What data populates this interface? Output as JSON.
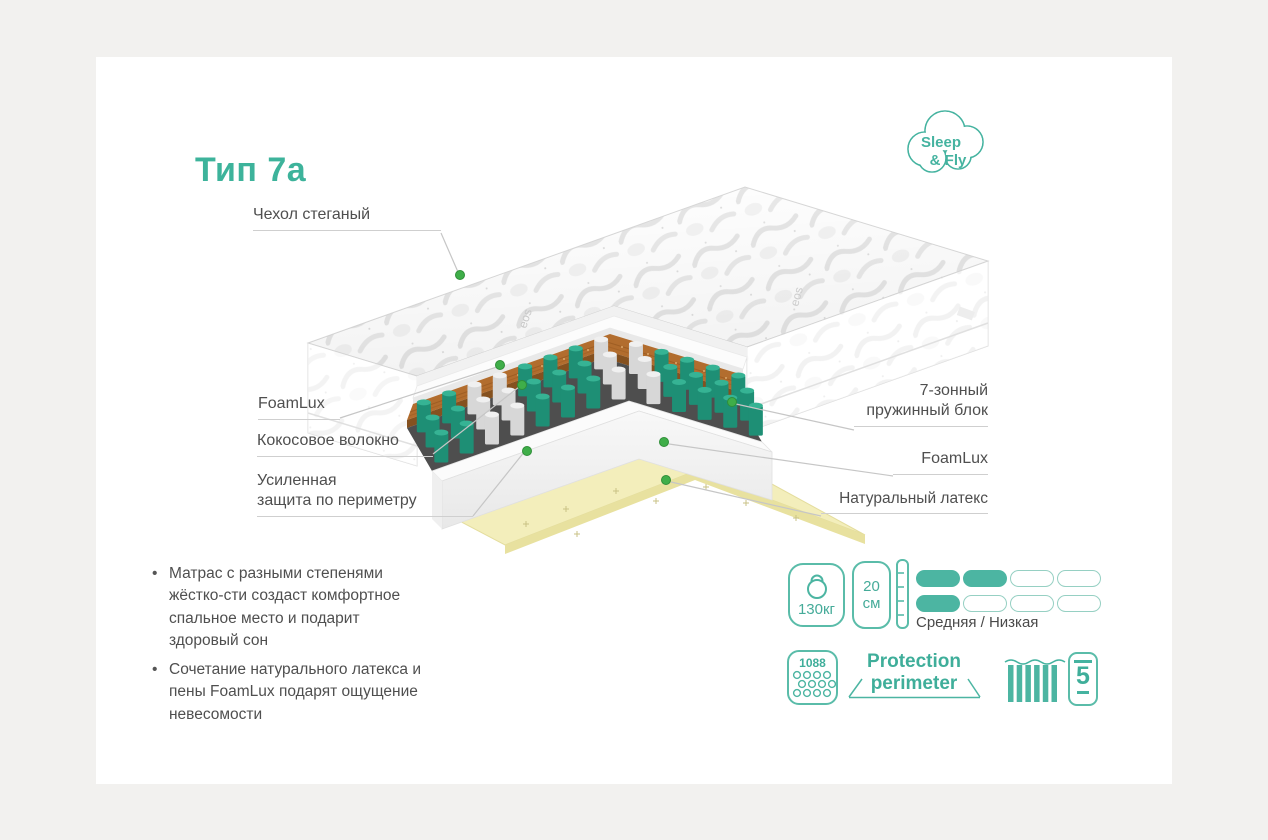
{
  "brand": {
    "line1": "Sleep",
    "line2": "& Fly"
  },
  "title": "Тип 7а",
  "labels": {
    "cover": "Чехол стеганый",
    "foamlux_left": "FoamLux",
    "coconut": "Кокосовое волокно",
    "perimeter_line1": "Усиленная",
    "perimeter_line2": "защита по периметру",
    "springs_line1": "7-зонный",
    "springs_line2": "пружинный блок",
    "foamlux_right": "FoamLux",
    "latex": "Натуральный латекс"
  },
  "bullets": [
    "Матрас с разными степенями жёстко-сти создаст комфортное  спальное место и подарит здоровый сон",
    "Сочетание натурального латекса и пены FoamLux подарят ощущение невесомости"
  ],
  "specs": {
    "weight": "130кг",
    "height_value": "20",
    "height_unit": "см",
    "firmness": {
      "rows": [
        [
          1,
          1,
          0,
          0
        ],
        [
          1,
          0,
          0,
          0
        ]
      ]
    },
    "firmness_label": "Средняя / Низкая",
    "springs_count": "1088",
    "protection_line1": "Protection",
    "protection_line2": "perimeter",
    "warranty": "5"
  },
  "icons": {
    "weight": "kettlebell-icon",
    "height": "height-ruler-icon",
    "springs_count": "pocket-springs-icon",
    "protection": "protection-perimeter-icon",
    "spring_block": "spring-bars-icon",
    "warranty": "warranty-5-icon"
  },
  "colors": {
    "teal": "#45b3a0",
    "green_dot": "#3fae49",
    "coconut": "#b26d2e",
    "latex": "#f3eebb",
    "spring_teal_body": "#1e8f75",
    "spring_teal_top": "#36b394",
    "spring_white_body": "#d7d7d7",
    "spring_white_top": "#f0f0f0",
    "label_gray": "#4f4f4f"
  },
  "illustration": {
    "zone_pattern": [
      "teal",
      "teal",
      "white",
      "white",
      "teal",
      "teal",
      "teal",
      "white",
      "white",
      "teal",
      "teal",
      "teal",
      "teal"
    ],
    "zones_note": "7-zone pocket spring block"
  }
}
